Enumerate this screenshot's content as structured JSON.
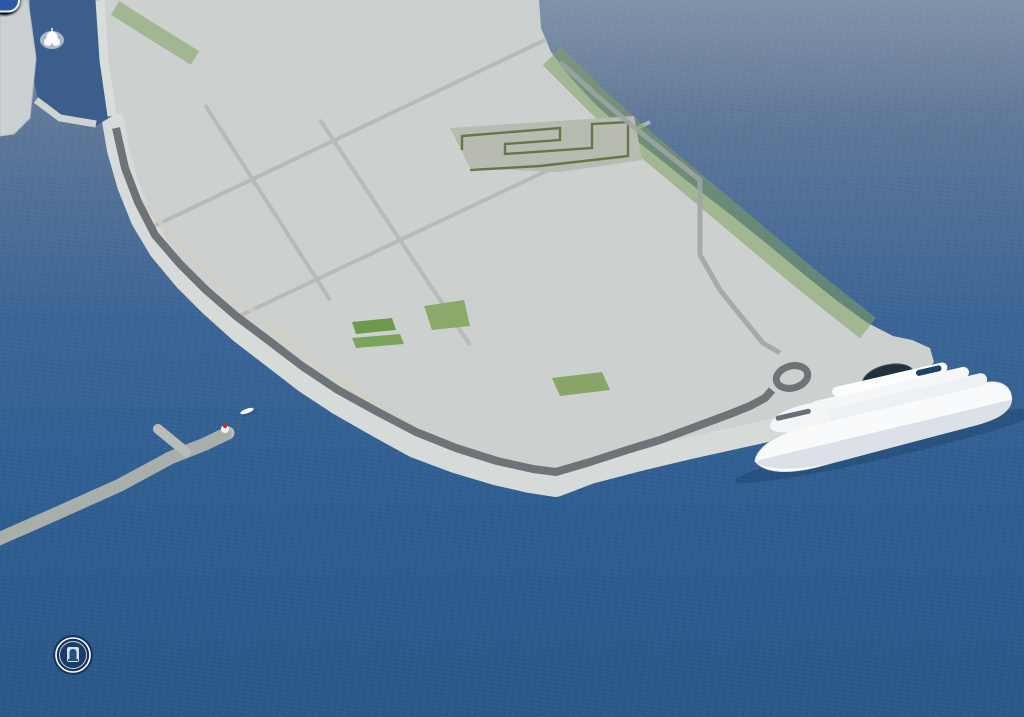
{
  "branding": {
    "name": "LUČKA UPRAVA ZADAR"
  },
  "markers": [
    {
      "id": "vez-10",
      "prefix": "VEZ",
      "number": "10",
      "x": 88,
      "y": 126
    },
    {
      "id": "vez-9",
      "prefix": "VEZ",
      "number": "9",
      "x": 76,
      "y": 147
    },
    {
      "id": "vez-8",
      "prefix": "VEZ",
      "number": "8",
      "x": 70,
      "y": 168
    },
    {
      "id": "vez-7",
      "prefix": "VEZ",
      "number": "7",
      "x": 77,
      "y": 193
    },
    {
      "id": "vez-6",
      "prefix": "VEZ",
      "number": "6",
      "x": 126,
      "y": 234
    },
    {
      "id": "vez-5",
      "prefix": "VEZ",
      "number": "5",
      "x": 183,
      "y": 281
    },
    {
      "id": "vez-4",
      "prefix": "VEZ",
      "number": "4",
      "x": 248,
      "y": 323
    },
    {
      "id": "vez-3",
      "prefix": "VEZ",
      "number": "3",
      "x": 317,
      "y": 380
    },
    {
      "id": "vez-2",
      "prefix": "VEZ",
      "number": "2",
      "x": 442,
      "y": 450
    },
    {
      "id": "vez-1",
      "prefix": "VEZ",
      "number": "1",
      "x": 637,
      "y": 453
    },
    {
      "id": "vez-1b",
      "prefix": "VEZ",
      "number": "1B",
      "x": 848,
      "y": 400
    },
    {
      "id": "vez-1c",
      "prefix": "VEZ",
      "number": "1C",
      "x": 646,
      "y": 164
    },
    {
      "id": "vez-1d",
      "prefix": "VEZ",
      "number": "1D",
      "x": 619,
      "y": 142
    }
  ],
  "colors": {
    "sea_top": "#8192a8",
    "sea_bottom": "#2a5788",
    "marker_circle": "#2a58a6",
    "marker_label_text": "#1d2c4e",
    "land": "#ccd1cf",
    "road": "#6e7377",
    "building_top": "#f2f3f1",
    "tree_green": "#4c7d3c",
    "brand_text": "#ffffff"
  }
}
